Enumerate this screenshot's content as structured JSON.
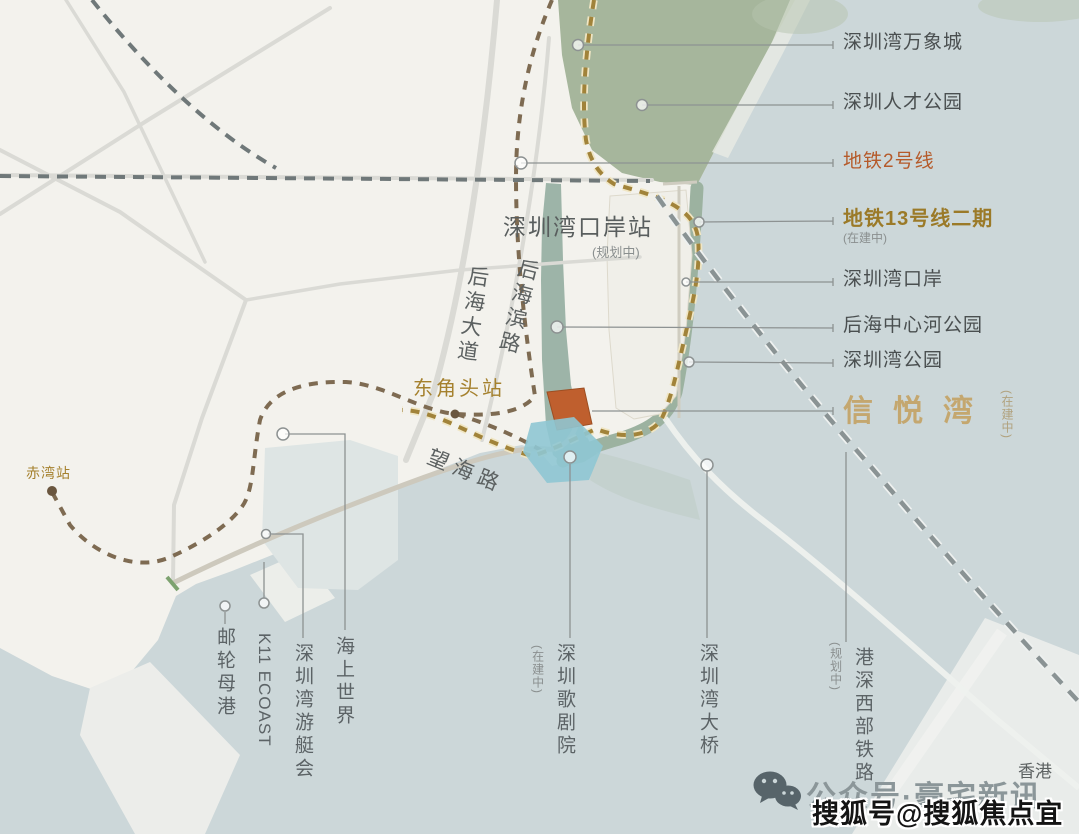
{
  "colors": {
    "sea": "#ccd7d9",
    "land": "#f3f2ed",
    "park": "#a6b69c",
    "river": "#9db4a8",
    "metro2_line": "#6f7879",
    "metro13_line": "#a1833a",
    "metro13_casing": "#f0e6c4",
    "metro_brown_line": "#7e6b52",
    "railway_line": "#8a9394",
    "site_orange": "#bf5f2e",
    "site_blue": "#8fc6d3",
    "accent_orange": "#b55a2a",
    "accent_gold": "#9b7a28",
    "project_gold": "#c4a367",
    "text_dark": "#4a4f50",
    "text_note": "#8a8f8f",
    "leader": "#8d9292"
  },
  "map_labels": [
    {
      "name": "shenzhen-bay-port-station-label",
      "text": "深圳湾口岸站"
    },
    {
      "name": "shenzhen-bay-port-station-note",
      "text": "(规划中)"
    },
    {
      "name": "houhai-avenue-road-label",
      "text": "后海大道"
    },
    {
      "name": "houhai-binlu-road-label",
      "text": "后海滨路"
    },
    {
      "name": "dongjiaotou-station-label",
      "text": "东角头站"
    },
    {
      "name": "wanghai-road-label",
      "text": "望海路"
    },
    {
      "name": "chiwan-station-label",
      "text": "赤湾站"
    },
    {
      "name": "hongkong-label",
      "text": "香港"
    }
  ],
  "callouts_right": [
    {
      "name": "callout-shenzhen-bay-mixc",
      "label": "深圳湾万象城",
      "accent": null
    },
    {
      "name": "callout-talent-park",
      "label": "深圳人才公园",
      "accent": null
    },
    {
      "name": "callout-metro-line-2",
      "label": "地铁2号线",
      "accent": "orange"
    },
    {
      "name": "callout-metro-line-13-phase2",
      "label": "地铁13号线二期",
      "sub": "(在建中)",
      "accent": "gold"
    },
    {
      "name": "callout-shenzhen-bay-port",
      "label": "深圳湾口岸",
      "accent": null
    },
    {
      "name": "callout-houhai-river-park",
      "label": "后海中心河公园",
      "accent": null
    },
    {
      "name": "callout-shenzhen-bay-park",
      "label": "深圳湾公园",
      "accent": null
    }
  ],
  "project": {
    "name": "信悦湾",
    "status": "(在建中)"
  },
  "callouts_bottom": [
    {
      "name": "callout-cruise-home-port",
      "label": "邮轮母港"
    },
    {
      "name": "callout-k11-ecoast",
      "label": "K11 ECOAST",
      "latin": true
    },
    {
      "name": "callout-yacht-club",
      "label": "深圳湾游艇会"
    },
    {
      "name": "callout-sea-world",
      "label": "海上世界"
    },
    {
      "name": "callout-opera-house",
      "label": "深圳歌剧院",
      "note": "(在建中)"
    },
    {
      "name": "callout-bay-bridge",
      "label": "深圳湾大桥"
    },
    {
      "name": "callout-west-rail",
      "label": "港深西部铁路",
      "note": "(规划中)"
    }
  ],
  "footer": {
    "wechat_text": "公众号·豪宅新讯",
    "watermark": "搜狐号@搜狐焦点宜春站"
  }
}
